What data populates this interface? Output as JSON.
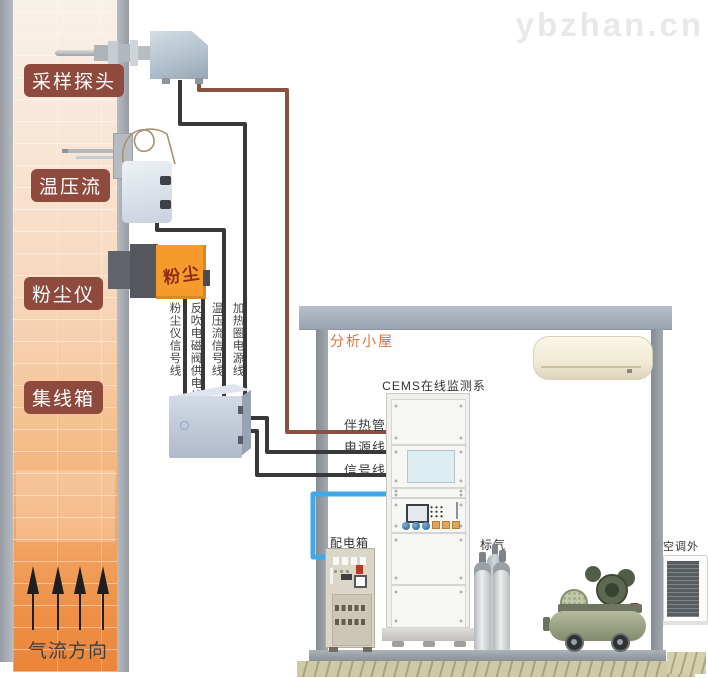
{
  "watermark": "ybzhan.cn",
  "colors": {
    "wire_dark": "#38383a",
    "wire_heat": "#8a5040",
    "wire_blue": "#3fa9e8",
    "label_bg": "#8e4a3c",
    "dust_box": "#f49b2b",
    "cabin_label": "#e46f38"
  },
  "stack": {
    "equipment_labels": [
      "采样探头",
      "温压流",
      "粉尘仪",
      "集线箱"
    ],
    "airflow_label": "气流方向",
    "dust_box_text": "粉尘"
  },
  "cables": {
    "vertical_labels": [
      "粉尘仪信号线",
      "反吹电磁阀供电线",
      "温压流信号线",
      "加热圈电源线"
    ],
    "heat_trace_label": "伴热管",
    "power_label": "电源线",
    "signal_label": "信号线"
  },
  "cabin": {
    "title": "分析小屋",
    "cems_label": "CEMS在线监测系统",
    "power_box_label": "配电箱",
    "gas_label": "标气",
    "ac_outdoor_label": "空调外机"
  }
}
